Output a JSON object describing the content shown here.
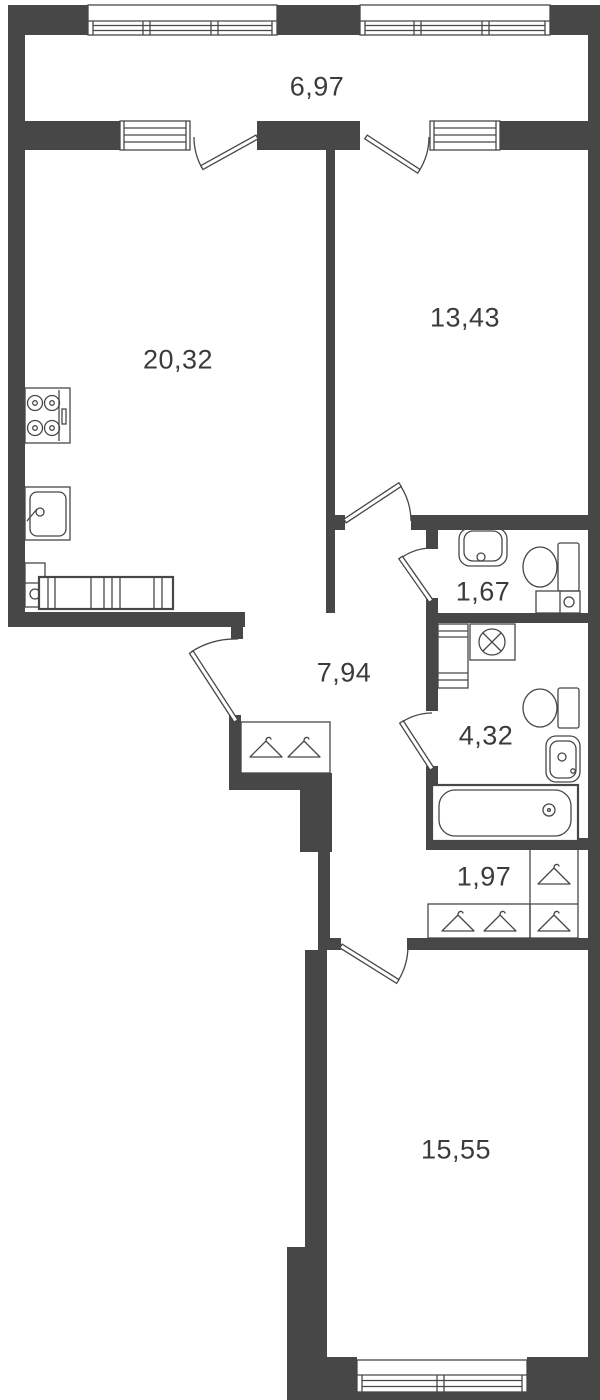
{
  "title": "apartment-floor-plan",
  "rooms": {
    "balcony": {
      "name": "balcony",
      "area": "6,97"
    },
    "kitchen_living": {
      "name": "kitchen-living-room",
      "area": "20,32"
    },
    "bedroom": {
      "name": "bedroom",
      "area": "13,43"
    },
    "hallway": {
      "name": "hallway",
      "area": "7,94"
    },
    "wc": {
      "name": "wc",
      "area": "1,67"
    },
    "bathroom": {
      "name": "bathroom",
      "area": "4,32"
    },
    "wardrobe_hall": {
      "name": "wardrobe-hall",
      "area": "1,97"
    },
    "bedroom_main": {
      "name": "bedroom-main",
      "area": "15,55"
    }
  },
  "fixtures": [
    "stove",
    "kitchen-sink",
    "kitchen-cabinet",
    "counter-sofa",
    "washbasin",
    "toilet",
    "boiler-box",
    "washing-machine",
    "bathroom-cabinet",
    "bathtub",
    "hangers",
    "wardrobes"
  ],
  "colors": {
    "wall": "#474747",
    "line": "#474747",
    "label": "#3b3b3b",
    "background": "#ffffff"
  }
}
